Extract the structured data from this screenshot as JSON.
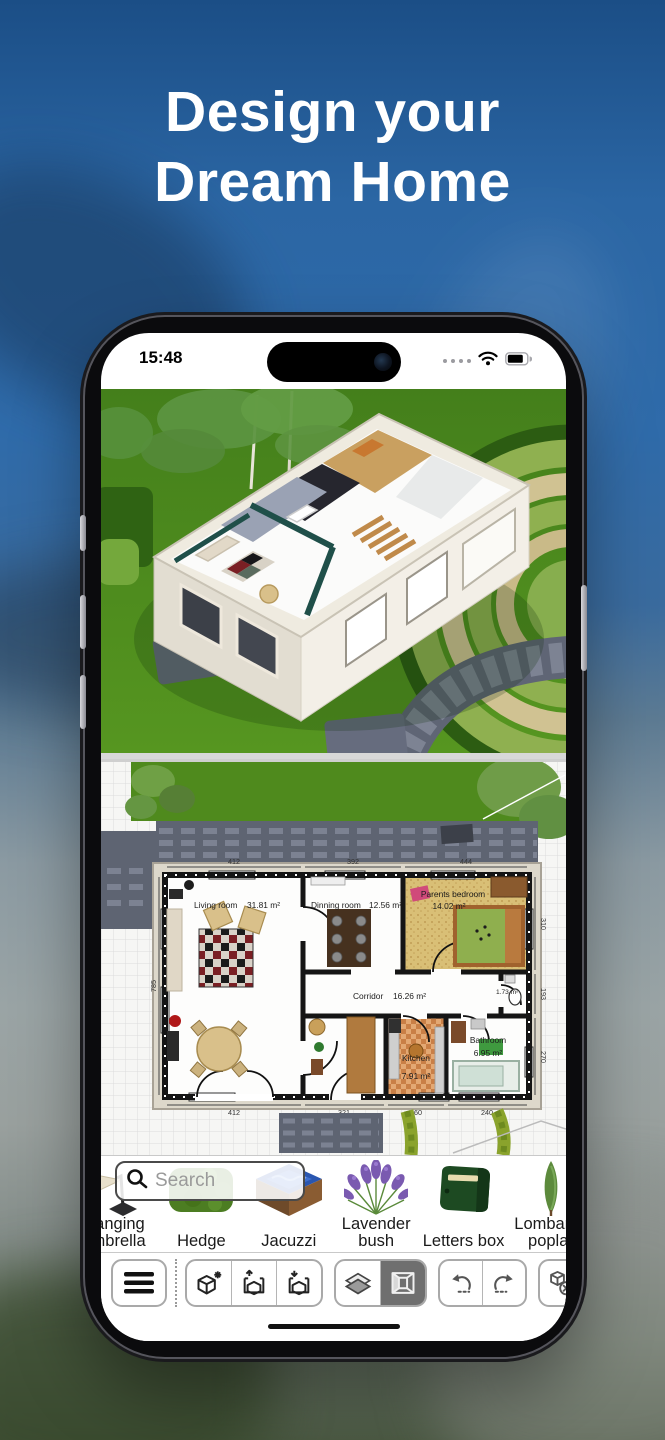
{
  "hero": {
    "line1": "Design your",
    "line2": "Dream Home"
  },
  "status": {
    "time": "15:48"
  },
  "floorplan": {
    "rooms": [
      {
        "name": "Living room",
        "area": "31.81 m²"
      },
      {
        "name": "Dinning room",
        "area": "12.56 m²"
      },
      {
        "name": "Parents bedroom",
        "area": "14.02 m²"
      },
      {
        "name": "Corridor",
        "area": "16.26 m²"
      },
      {
        "name": "Kitchen",
        "area": "7.91 m²"
      },
      {
        "name": "Bathroom",
        "area": "6.95 m²"
      },
      {
        "area": "1.73 m²"
      }
    ],
    "dimensions": {
      "top": [
        "412",
        "392",
        "444"
      ],
      "bottom": [
        "412",
        "321",
        "260",
        "240"
      ],
      "left": [
        "785"
      ],
      "right": [
        "310",
        "193",
        "270"
      ]
    }
  },
  "library": {
    "search_placeholder": "Search",
    "items": [
      "Hanging umbrella",
      "Hedge",
      "Jacuzzi",
      "Lavender bush",
      "Letters box",
      "Lombardy poplar"
    ]
  },
  "toolbar": {
    "buttons": [
      {
        "name": "menu"
      },
      {
        "name": "new-object"
      },
      {
        "name": "export-project"
      },
      {
        "name": "import-project"
      },
      {
        "name": "view-2d"
      },
      {
        "name": "view-3d",
        "selected": true
      },
      {
        "name": "undo"
      },
      {
        "name": "redo"
      },
      {
        "name": "delete-object"
      },
      {
        "name": "select-copy"
      }
    ]
  },
  "colors": {
    "hero_background": "#2b66a4",
    "lawn_green": "#4f8a1d",
    "toolbar_selected": "#6f6f6f",
    "bedroom_floor": "#d9bf76",
    "kitchen_floor": "#d08a52"
  }
}
